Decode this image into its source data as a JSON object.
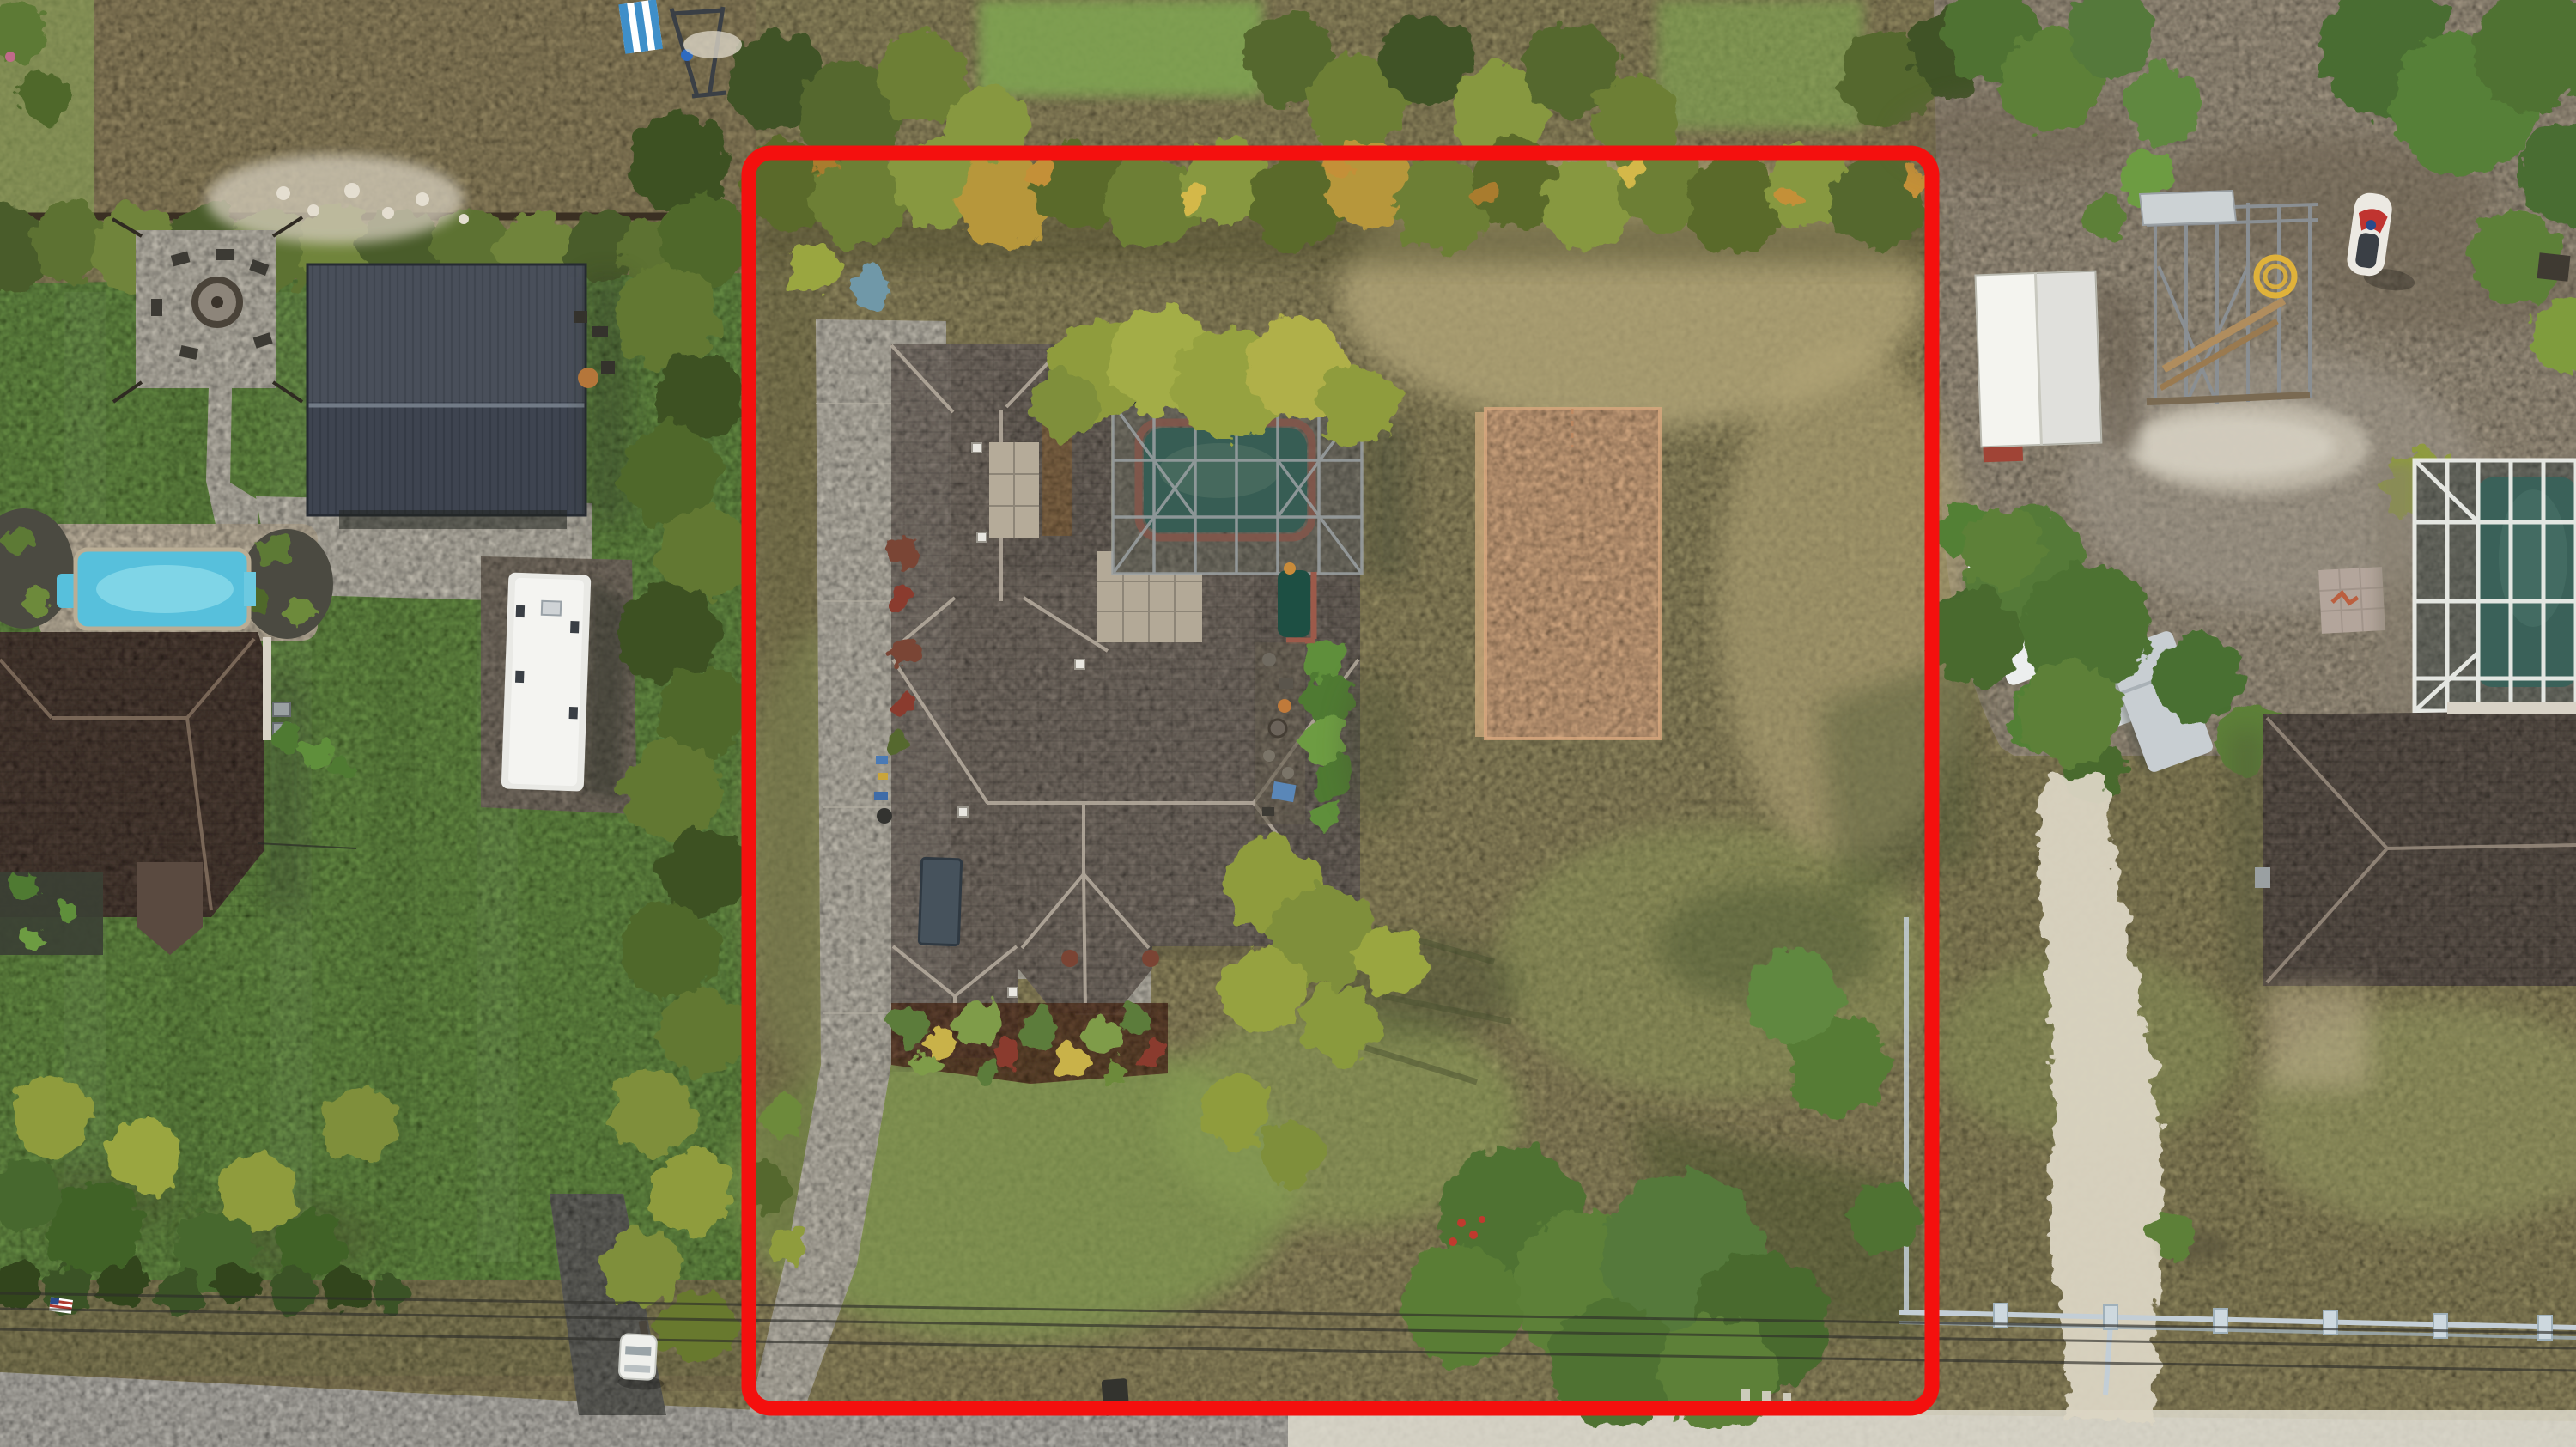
{
  "photo": {
    "kind": "aerial-drone-photograph",
    "subject": "residential acreage lot outlined with a red property-boundary overlay",
    "visible_text": "",
    "objects": [
      "red boundary outline around subject lot",
      "main house with gray shingle hip roof and skylight",
      "dark screened pool enclosure with green pool and pink coping",
      "orange painted sport pad in side yard",
      "concrete driveway running to the road",
      "tropical hedge along north and west lot lines",
      "dry patchy lawn with tree cluster near road",
      "neighbor barn with dark metal roof",
      "neighbor fire-pit patio with chairs",
      "neighbor swimming pool with travertine deck",
      "neighbor travel trailer on gravel pad",
      "neighbor house with dark brown hip roof",
      "dirt lot with metal frame structure, white canopy and utility trailers",
      "jet ski on stand and coiled yellow hose",
      "light PVC rail fence along right road frontage",
      "overhead power lines along road verge",
      "white sand road across the bottom",
      "white car parked on neighbor asphalt drive",
      "striped lounger and play frame at top edge"
    ]
  },
  "colors": {
    "boundary_red": "#f4100e",
    "grass_dry": "#a79d6f",
    "grass_green": "#77a351",
    "dirt": "#b8ab95",
    "road": "#cfccc4",
    "sand_path": "#dcd5c3",
    "concrete": "#d7d2c4",
    "roof_main": "#8b8177",
    "roof_left": "#5a4a40",
    "roof_right": "#6e645a",
    "barn": "#3e4450",
    "pool_teal": "#46857a",
    "pool_blue": "#57c0dc",
    "coping_pink": "#c5796a",
    "court_orange": "#edbd92",
    "rv_white": "#e9e9e5",
    "canopy_white": "#f4f4ef",
    "fence_pvc": "#c3ced6",
    "deck_tan": "#dccfb7",
    "screen_dark": "#23271f"
  }
}
